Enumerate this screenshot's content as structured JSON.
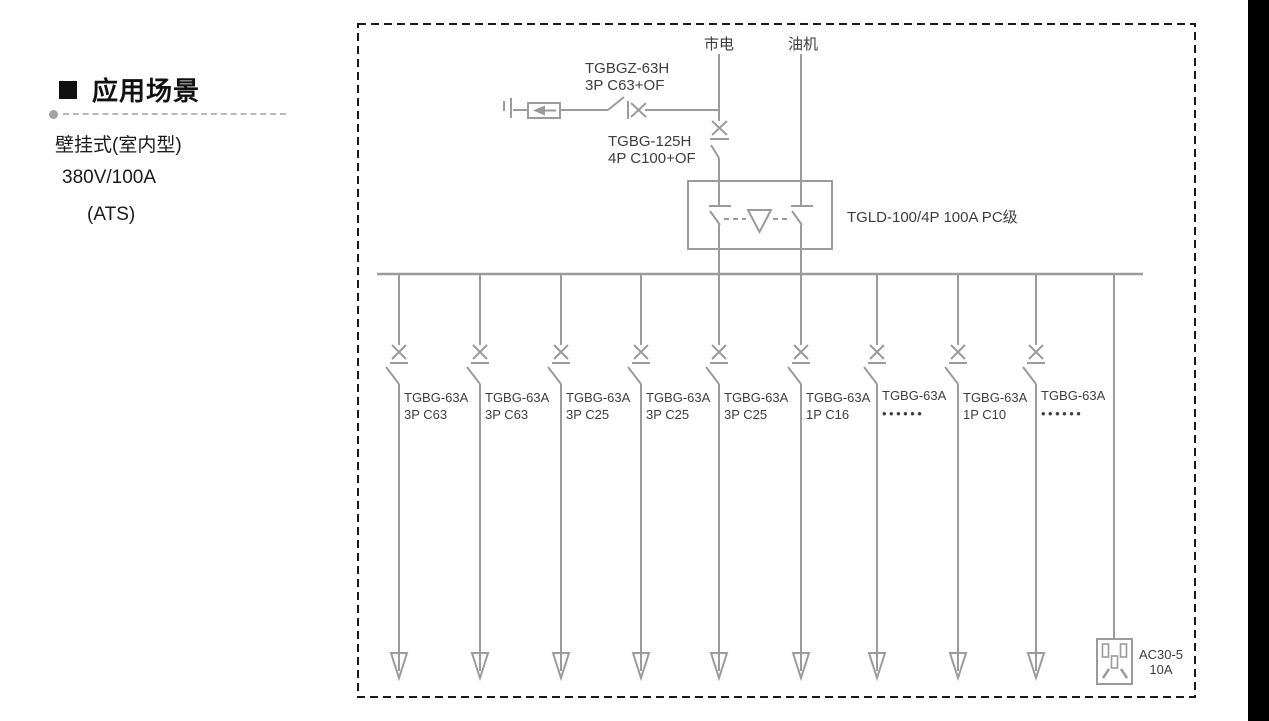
{
  "sidebar": {
    "title": "应用场景",
    "items": [
      "壁挂式(室内型)",
      "380V/100A",
      "(ATS)"
    ]
  },
  "diagram": {
    "mains_label": "市电",
    "generator_label": "油机",
    "spd_breaker": {
      "model": "TGBGZ-63H",
      "spec": "3P C63+OF"
    },
    "main_breaker": {
      "model": "TGBG-125H",
      "spec": "4P C100+OF"
    },
    "ats_label": "TGLD-100/4P 100A PC级",
    "branches": [
      {
        "model": "TGBG-63A",
        "spec": "3P C63"
      },
      {
        "model": "TGBG-63A",
        "spec": "3P C63"
      },
      {
        "model": "TGBG-63A",
        "spec": "3P C25"
      },
      {
        "model": "TGBG-63A",
        "spec": "3P C25"
      },
      {
        "model": "TGBG-63A",
        "spec": "3P C25"
      },
      {
        "model": "TGBG-63A",
        "spec": "1P C16"
      },
      {
        "model": "TGBG-63A",
        "spec": "••••••"
      },
      {
        "model": "TGBG-63A",
        "spec": "1P C10"
      },
      {
        "model": "TGBG-63A",
        "spec": "••••••"
      }
    ],
    "socket": {
      "model": "AC30-5",
      "rating": "10A"
    },
    "colors": {
      "line": "#9b9b9b",
      "text": "#3d3d3d",
      "border": "#1a1a1a",
      "edge_bar": "#000000"
    }
  }
}
